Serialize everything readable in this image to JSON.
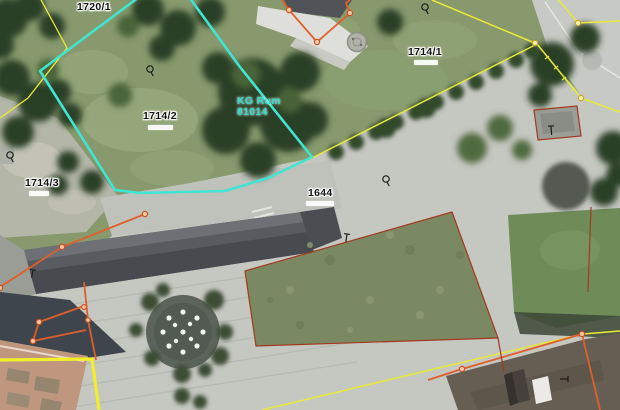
{
  "map": {
    "kg_label": {
      "line1": "KG Rum",
      "line2": "81014"
    },
    "parcels": [
      {
        "number": "1720/1"
      },
      {
        "number": "1714/1",
        "area_label": ""
      },
      {
        "number": "1714/2",
        "area_label": ""
      },
      {
        "number": "1714/3",
        "area_label": ""
      },
      {
        "number": "1644",
        "area_label": ""
      }
    ],
    "selected_parcel_number": "1714/2",
    "colors": {
      "selection_boundary": "#40e5d2",
      "parcel_boundary_yellow": "#e9e938",
      "parcel_boundary_thick_yellow": "#f2ef2a",
      "building_outline_orange": "#df5f2c",
      "detail_outline_dark_red": "#a13a20",
      "kg_label_text": "#29ddd0",
      "parcel_label_text": "#141414",
      "label_halo": "#ffffff"
    },
    "symbols": {
      "survey_point": "circle-with-tail",
      "boundary_marker": "corner-tick"
    }
  }
}
